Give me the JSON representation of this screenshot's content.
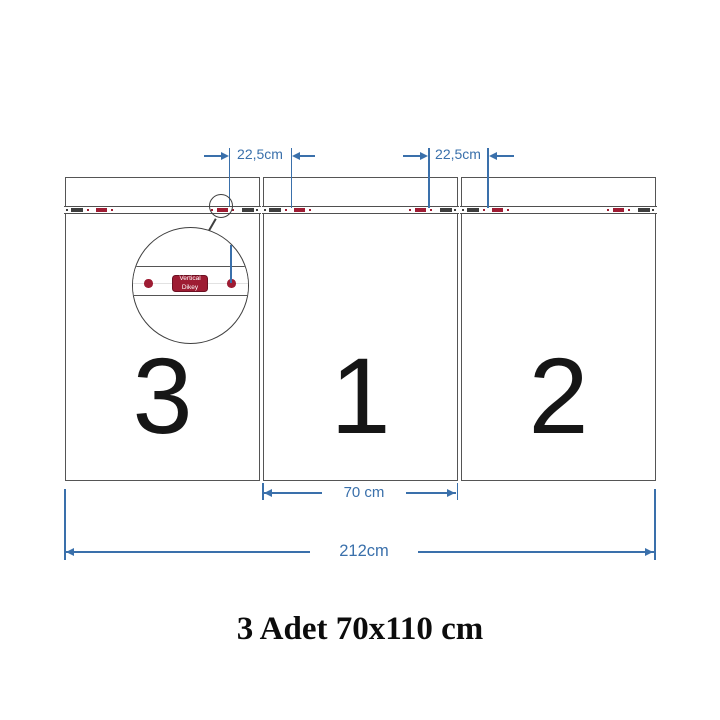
{
  "title": "3 Adet 70x110 cm",
  "panels": [
    {
      "number": "3"
    },
    {
      "number": "1"
    },
    {
      "number": "2"
    }
  ],
  "dimensions": {
    "top_left_label": "22,5cm",
    "top_right_label": "22,5cm",
    "middle_width_label": "70 cm",
    "total_width_label": "212cm"
  },
  "magnifier": {
    "label_line1": "Vertical",
    "label_line2": "Dikey"
  },
  "colors": {
    "dimension_blue": "#3a70ab",
    "mark_red": "#9e1c33",
    "mark_dark": "#3e3e3e",
    "panel_border": "#555555",
    "number_black": "#161616",
    "title_black": "#0c0c0c"
  }
}
